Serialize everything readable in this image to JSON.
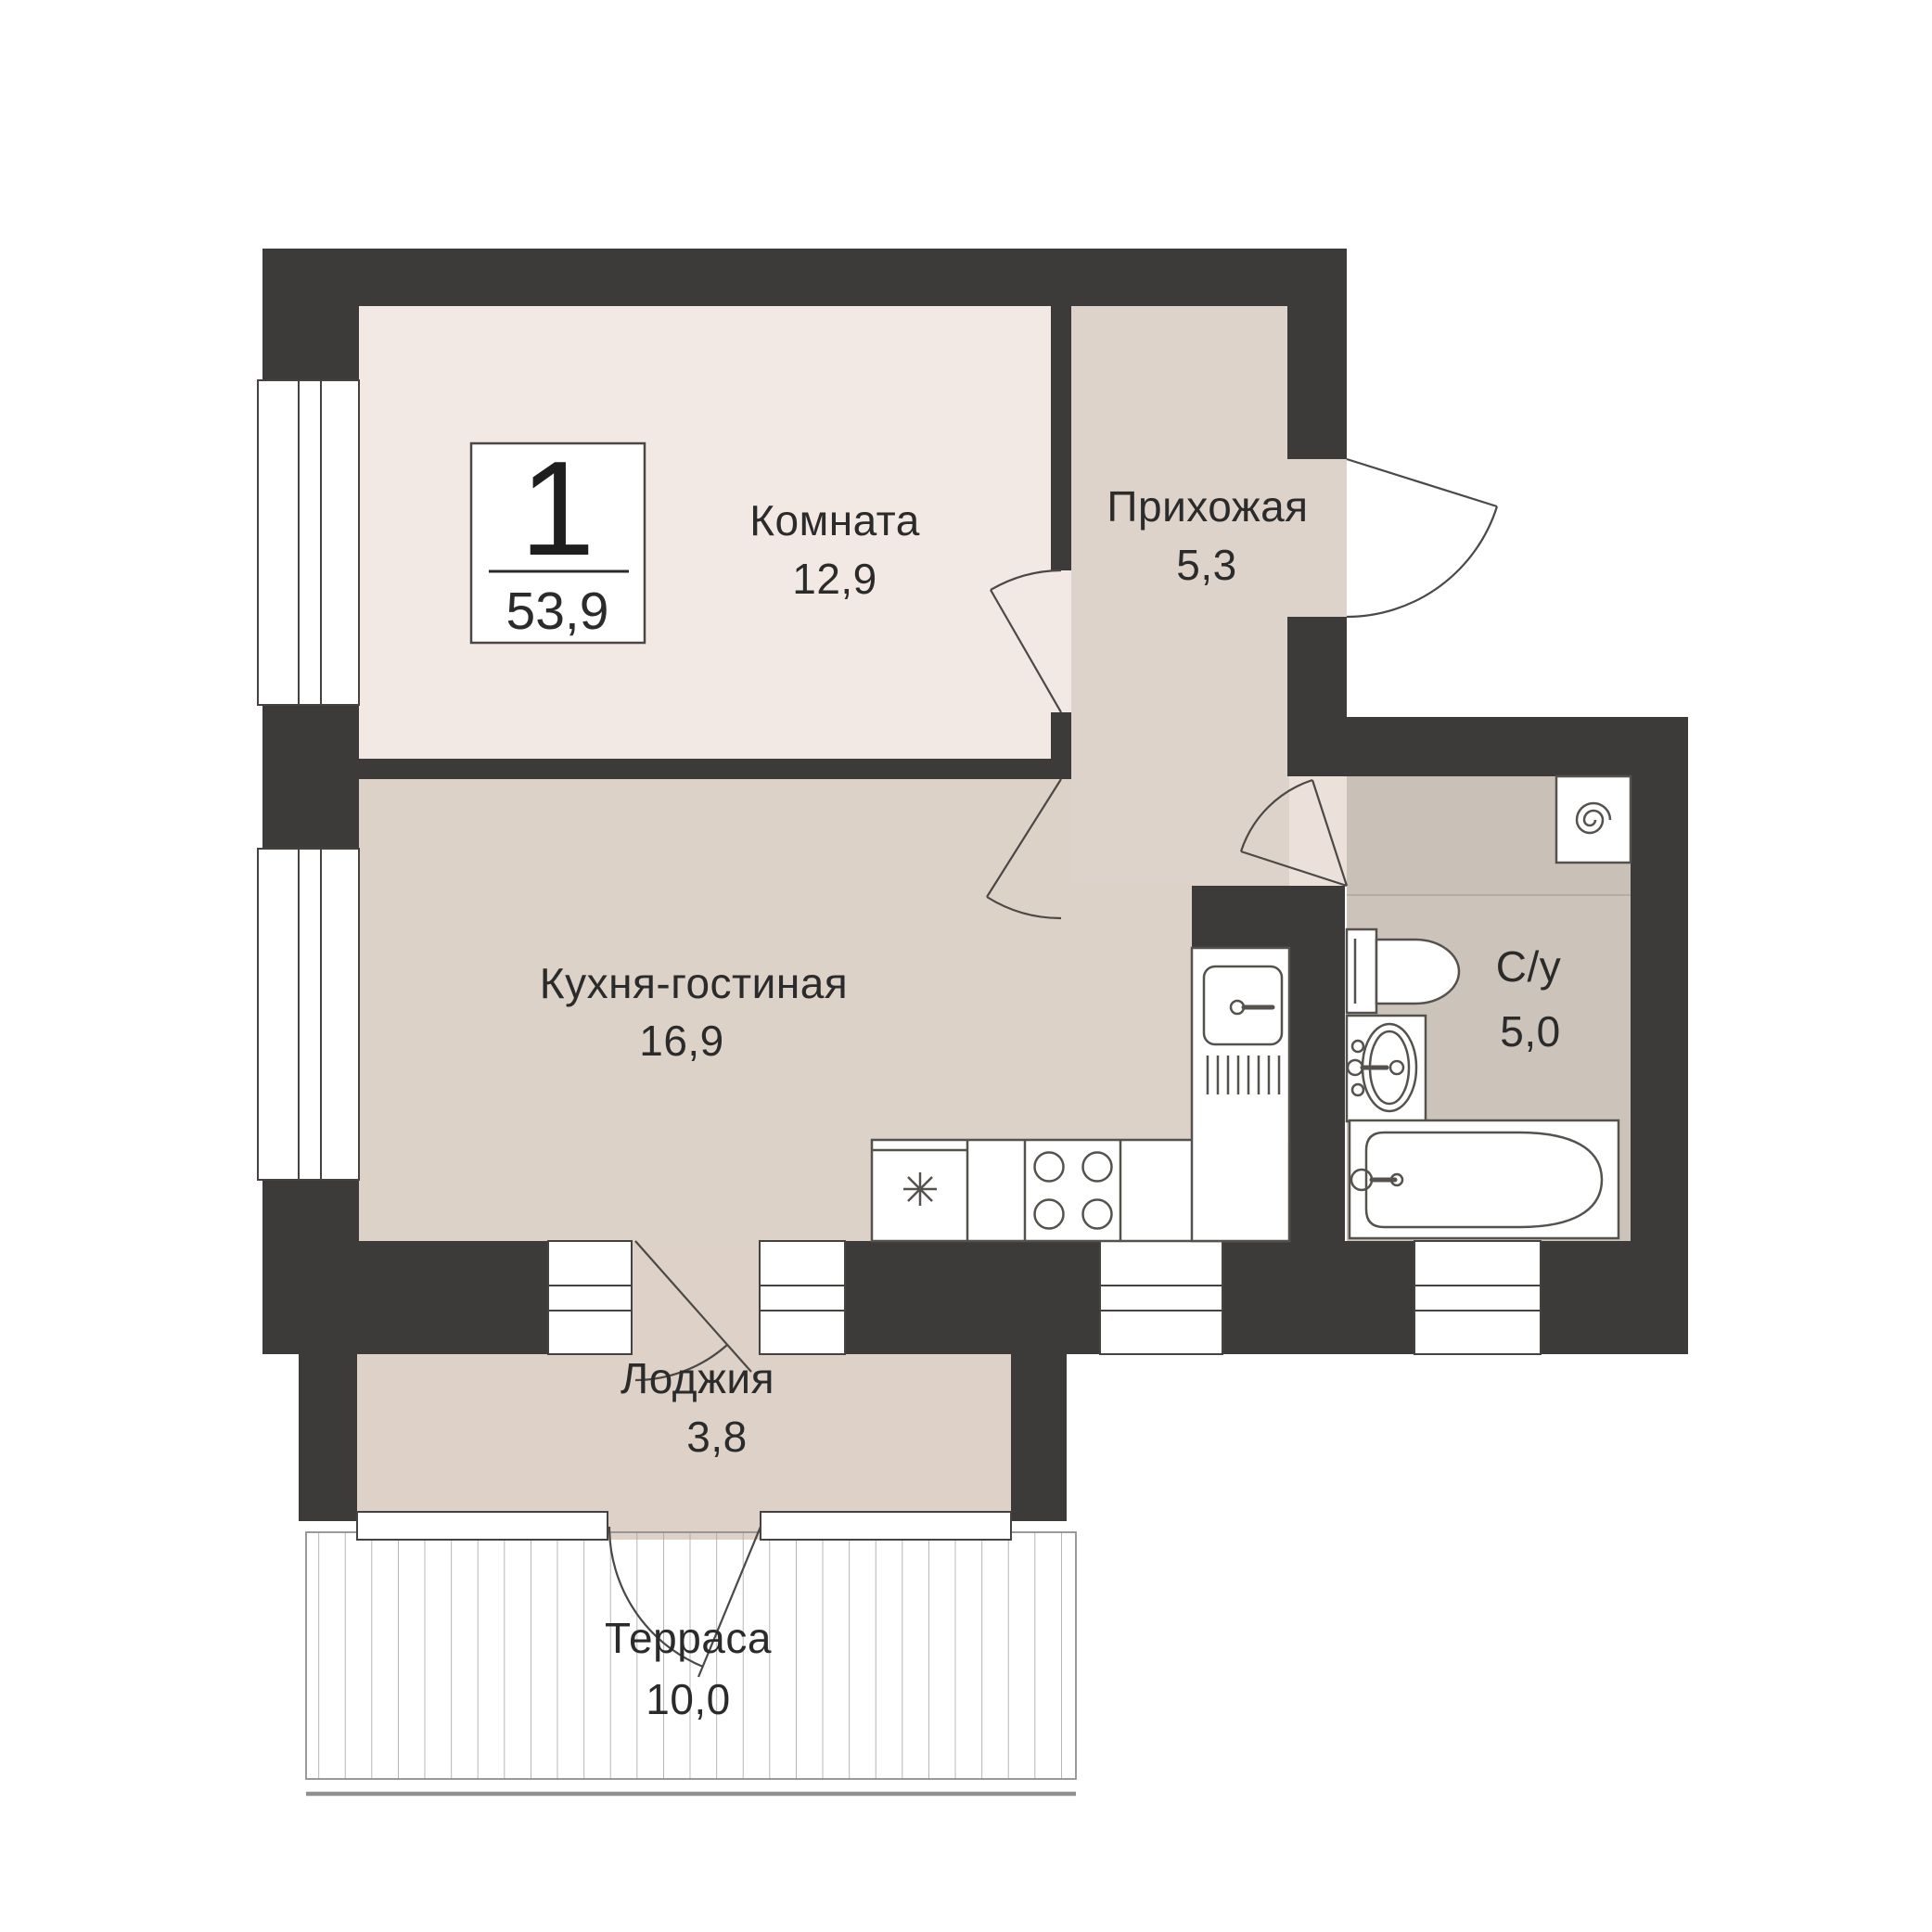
{
  "badge": {
    "room_count": "1",
    "total_area": "53,9"
  },
  "rooms": [
    {
      "name": "Комната",
      "area": "12,9"
    },
    {
      "name": "Прихожая",
      "area": "5,3"
    },
    {
      "name": "Кухня-гостиная",
      "area": "16,9"
    },
    {
      "name": "С/у",
      "area": "5,0"
    },
    {
      "name": "Лоджия",
      "area": "3,8"
    },
    {
      "name": "Терраса",
      "area": "10,0"
    }
  ],
  "fixtures": [
    "refrigerator",
    "stove",
    "kitchen-sink",
    "washing-machine",
    "toilet",
    "washbasin",
    "bathtub"
  ],
  "colors": {
    "wall": "#3d3b39",
    "room": "#f3e9e4",
    "hall": "#ded3cb",
    "kitchen": "#ddd2c8",
    "bath": "#ccc3ba",
    "bath_upper": "#c9c0b7",
    "threshold": "#ebe1da",
    "loggia": "#ddd1c8",
    "text": "#2b2b2b",
    "hatch": "#a5a5a5"
  }
}
